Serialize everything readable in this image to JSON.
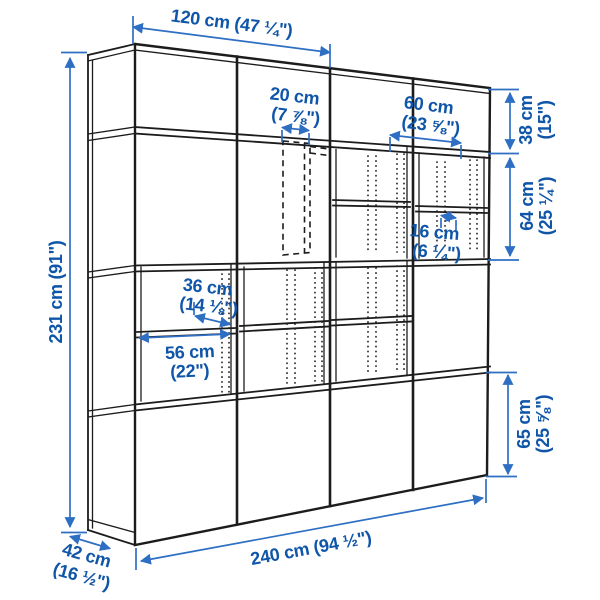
{
  "page": {
    "type": "product-dimension-diagram",
    "product": "wall storage combination with cabinets and open shelves",
    "background": "#ffffff"
  },
  "colors": {
    "dimension_text": "#0f55a8",
    "dimension_line": "#2e6fc4",
    "drawing_line": "#1c1c1c"
  },
  "dims": {
    "total_height": {
      "cm": 231,
      "label": "231 cm (91\")"
    },
    "total_width": {
      "cm": 240,
      "label": "240 cm (94 ½\")"
    },
    "depth": {
      "cm": 42,
      "line1": "42 cm",
      "line2": "(16 ½\")"
    },
    "upper_width": {
      "cm": 120,
      "label": "120 cm (47 ¼\")"
    },
    "niche_20": {
      "cm": 20,
      "line1": "20 cm",
      "line2": "(7 ⅞\")"
    },
    "cab_60": {
      "cm": 60,
      "line1": "60 cm",
      "line2": "(23 ⅝\")"
    },
    "h_38": {
      "cm": 38,
      "line1": "38 cm",
      "line2": "(15\")"
    },
    "h_64": {
      "cm": 64,
      "line1": "64 cm",
      "line2": "(25 ¼\")"
    },
    "h_65": {
      "cm": 65,
      "line1": "65 cm",
      "line2": "(25 ⅝\")"
    },
    "shelf_36": {
      "cm": 36,
      "line1": "36 cm",
      "line2": "(14 ⅛\")"
    },
    "inner_56": {
      "cm": 56,
      "line1": "56 cm",
      "line2": "(22\")"
    },
    "gap_16": {
      "cm": 16,
      "line1": "16 cm",
      "line2": "(6 ¼\")"
    }
  }
}
